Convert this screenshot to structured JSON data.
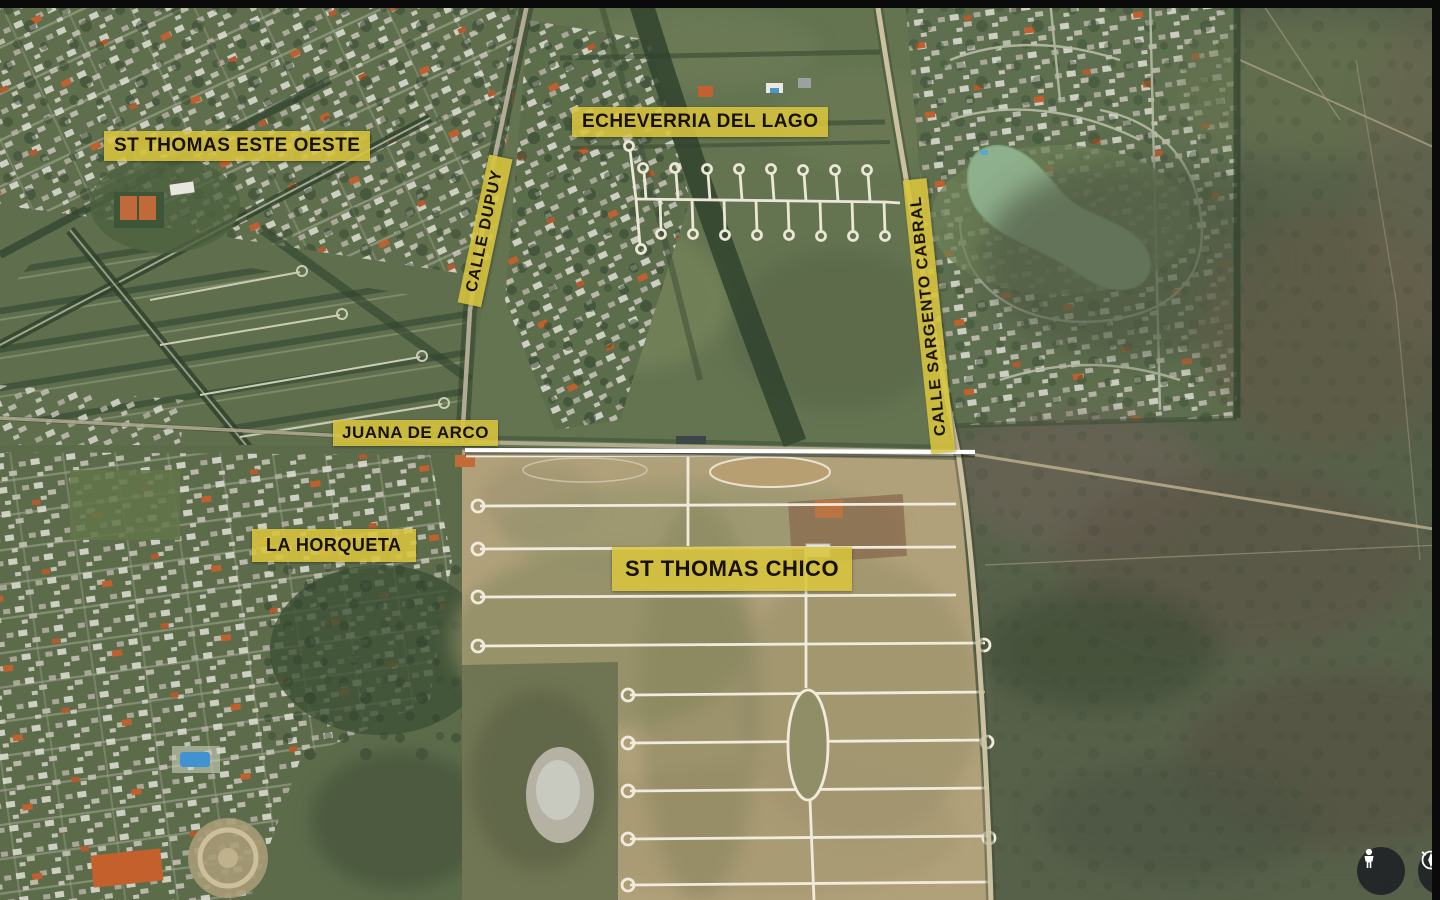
{
  "map": {
    "kind": "satellite-aerial-view",
    "labels": {
      "st_thomas_este_oeste": "ST THOMAS ESTE OESTE",
      "echeverria_del_lago": "ECHEVERRIA DEL LAGO",
      "calle_dupuy": "CALLE DUPUY",
      "calle_sargento_cabral": "CALLE SARGENTO CABRAL",
      "juana_de_arco": "JUANA DE ARCO",
      "la_horqueta": "LA HORQUETA",
      "st_thomas_chico": "ST THOMAS CHICO"
    },
    "annotation_style": {
      "label_bg": "#d8c53d",
      "label_text": "#181104",
      "highlight_line": "#ffffff"
    }
  },
  "controls": {
    "pegman": {
      "icon": "pegman-icon",
      "bg": "#1c1e22",
      "fg": "#ffffff"
    },
    "compass": {
      "icon": "compass-icon",
      "bg": "#1c1e22",
      "fg": "#ffffff"
    }
  },
  "frame": {
    "bar_color": "#0a0a0a"
  }
}
